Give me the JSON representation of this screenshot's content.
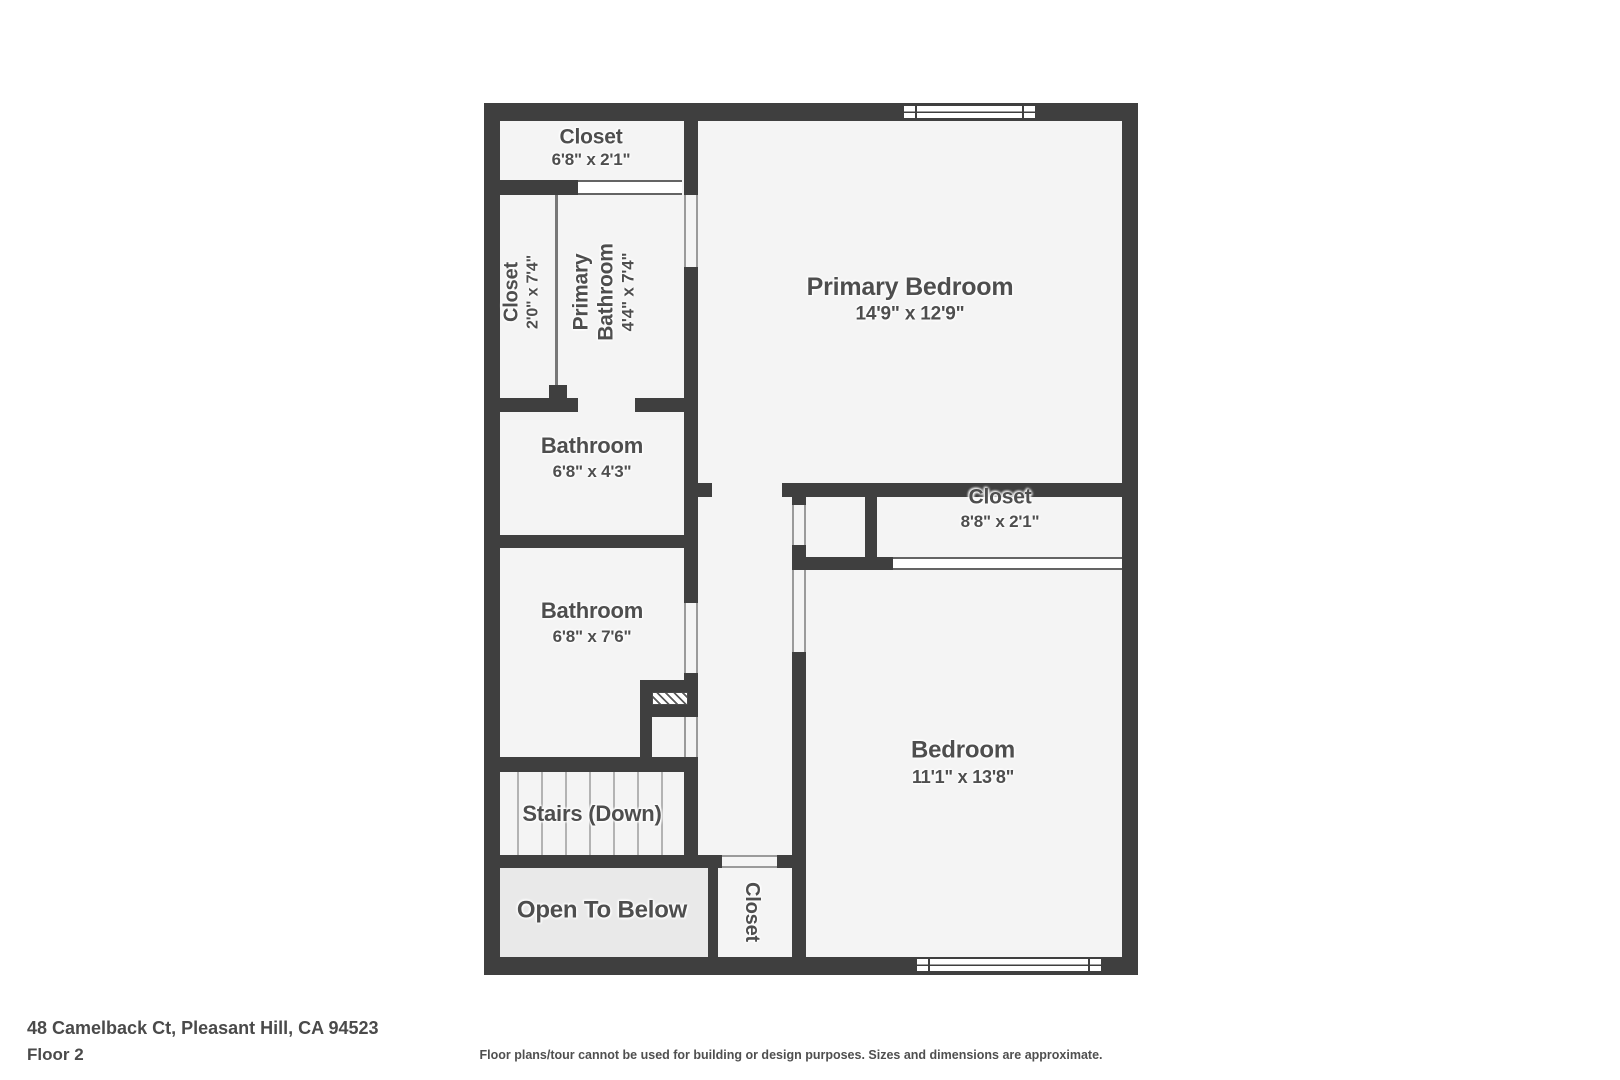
{
  "floorplan": {
    "rooms": {
      "closet_top": {
        "name": "Closet",
        "dims": "6'8\" x 2'1\""
      },
      "closet_left": {
        "name": "Closet",
        "dims": "2'0\" x 7'4\""
      },
      "primary_bathroom": {
        "name": "Primary Bathroom",
        "dims": "4'4\" x 7'4\""
      },
      "primary_bedroom": {
        "name": "Primary Bedroom",
        "dims": "14'9\" x 12'9\""
      },
      "bathroom_small": {
        "name": "Bathroom",
        "dims": "6'8\" x 4'3\""
      },
      "closet_right": {
        "name": "Closet",
        "dims": "8'8\" x 2'1\""
      },
      "bathroom_large": {
        "name": "Bathroom",
        "dims": "6'8\" x 7'6\""
      },
      "bedroom": {
        "name": "Bedroom",
        "dims": "11'1\" x 13'8\""
      },
      "stairs": {
        "name": "Stairs (Down)"
      },
      "open_to_below": {
        "name": "Open To Below"
      },
      "closet_bottom": {
        "name": "Closet"
      }
    },
    "footer": {
      "address": "48 Camelback Ct, Pleasant Hill, CA 94523",
      "floor": "Floor 2",
      "disclaimer": "Floor plans/tour cannot be used for building or design purposes. Sizes and dimensions are approximate."
    },
    "colors": {
      "wall": "#3f3f3f",
      "room_fill": "#f4f4f4",
      "open_to_below_fill": "#e9e9e9",
      "label_text": "#4e4e4e"
    }
  }
}
